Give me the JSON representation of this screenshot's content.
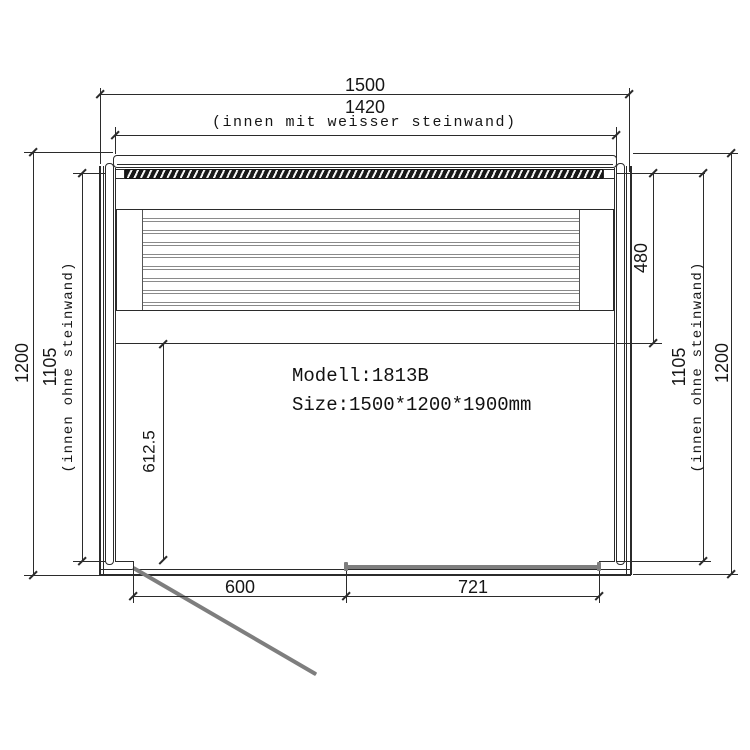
{
  "text": {
    "model": "Modell:1813B",
    "size": "Size:1500*1200*1900mm"
  },
  "dims": {
    "outer_width": "1500",
    "inner_width": "1420",
    "inner_width_note": "(innen mit weisser steinwand)",
    "left_outer_depth": "1200",
    "left_inner_depth": "1105",
    "left_inner_depth_note": "(innen ohne steinwand)",
    "bench_depth": "480",
    "right_inner_depth": "1105",
    "right_inner_depth_note": "(innen ohne steinwand)",
    "right_outer_depth": "1200",
    "floor_front_depth": "612.5",
    "door_opening_width": "600",
    "glass_front_width": "721"
  },
  "colors": {
    "line": "#2b2b2b",
    "steel_gray": "#7e7e7e",
    "background": "#ffffff"
  }
}
